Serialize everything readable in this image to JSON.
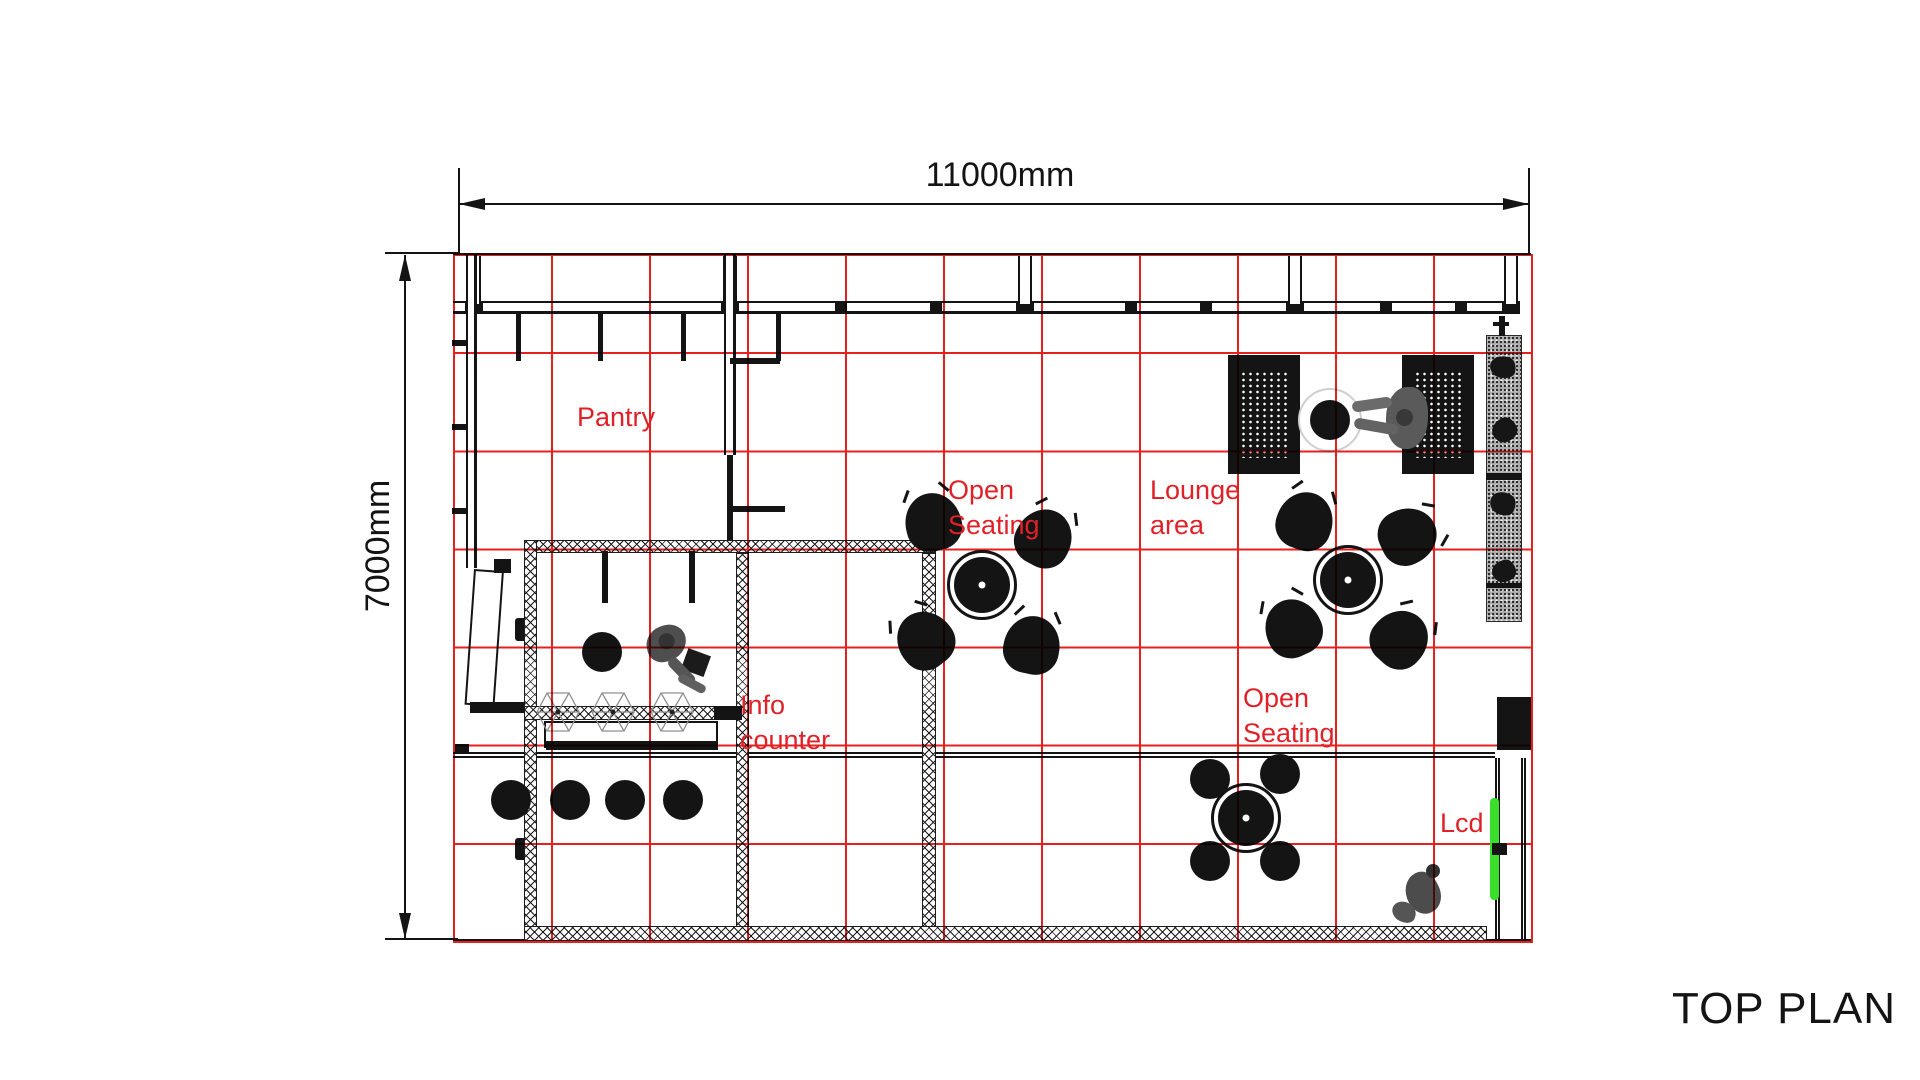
{
  "title": "TOP PLAN",
  "dimensions": {
    "horizontal": "11000mm",
    "vertical": "7000mm"
  },
  "rooms": {
    "pantry": "Pantry",
    "open_seating_1": "Open\nSeating",
    "lounge_area": "Lounge\narea",
    "info_counter": "Info\ncounter",
    "open_seating_2": "Open\nSeating",
    "lcd": "Lcd"
  },
  "grid": {
    "columns": 11,
    "rows": 7
  },
  "colors": {
    "grid_red": "#e6201f",
    "label_red": "#e02128",
    "lcd_screen_green": "#3ade2b",
    "ink": "#141414"
  }
}
